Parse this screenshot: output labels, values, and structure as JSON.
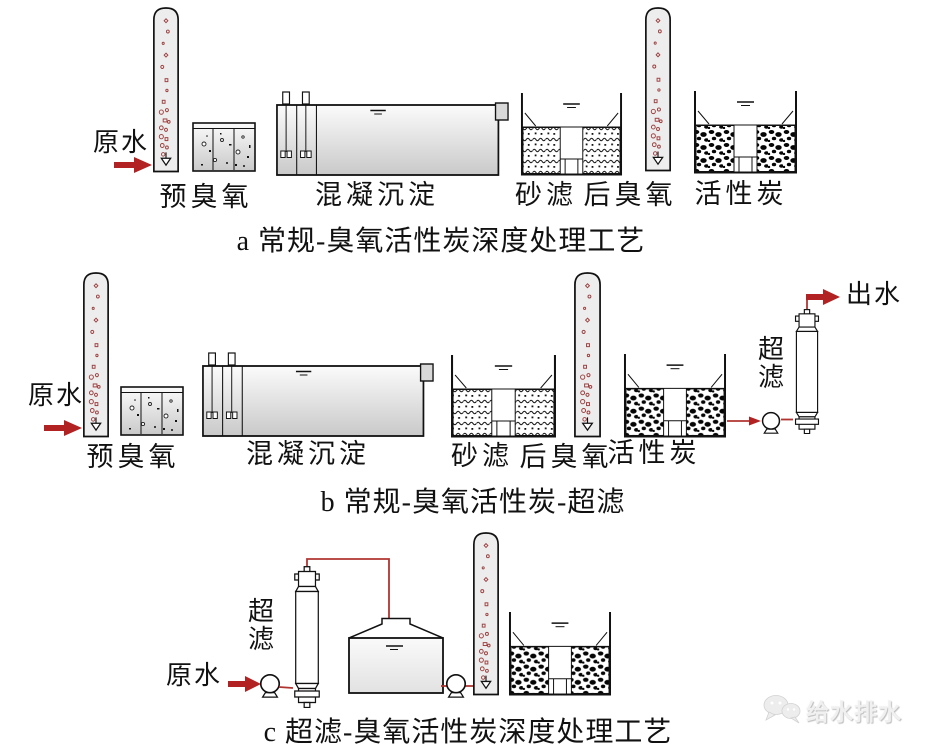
{
  "figure": {
    "labels": {
      "raw_water": "原水",
      "effluent": "出水",
      "pre_ozone": "预臭氧",
      "coagulation_sedimentation": "混凝沉淀",
      "sand_filter": "砂滤",
      "post_ozone": "后臭氧",
      "activated_carbon": "活性炭",
      "ultrafiltration": "超滤"
    },
    "captions": {
      "a": "a 常规-臭氧活性炭深度处理工艺",
      "b": "b 常规-臭氧活性炭-超滤",
      "c": "c 超滤-臭氧活性炭深度处理工艺"
    },
    "watermark": {
      "icon": "wechat-icon",
      "text": "给水排水"
    },
    "colors": {
      "flow_red": "#b22222",
      "bubble_red": "#9c3f3f",
      "outline_black": "#111111",
      "vessel_gray": "#ededed",
      "background": "#ffffff"
    }
  }
}
